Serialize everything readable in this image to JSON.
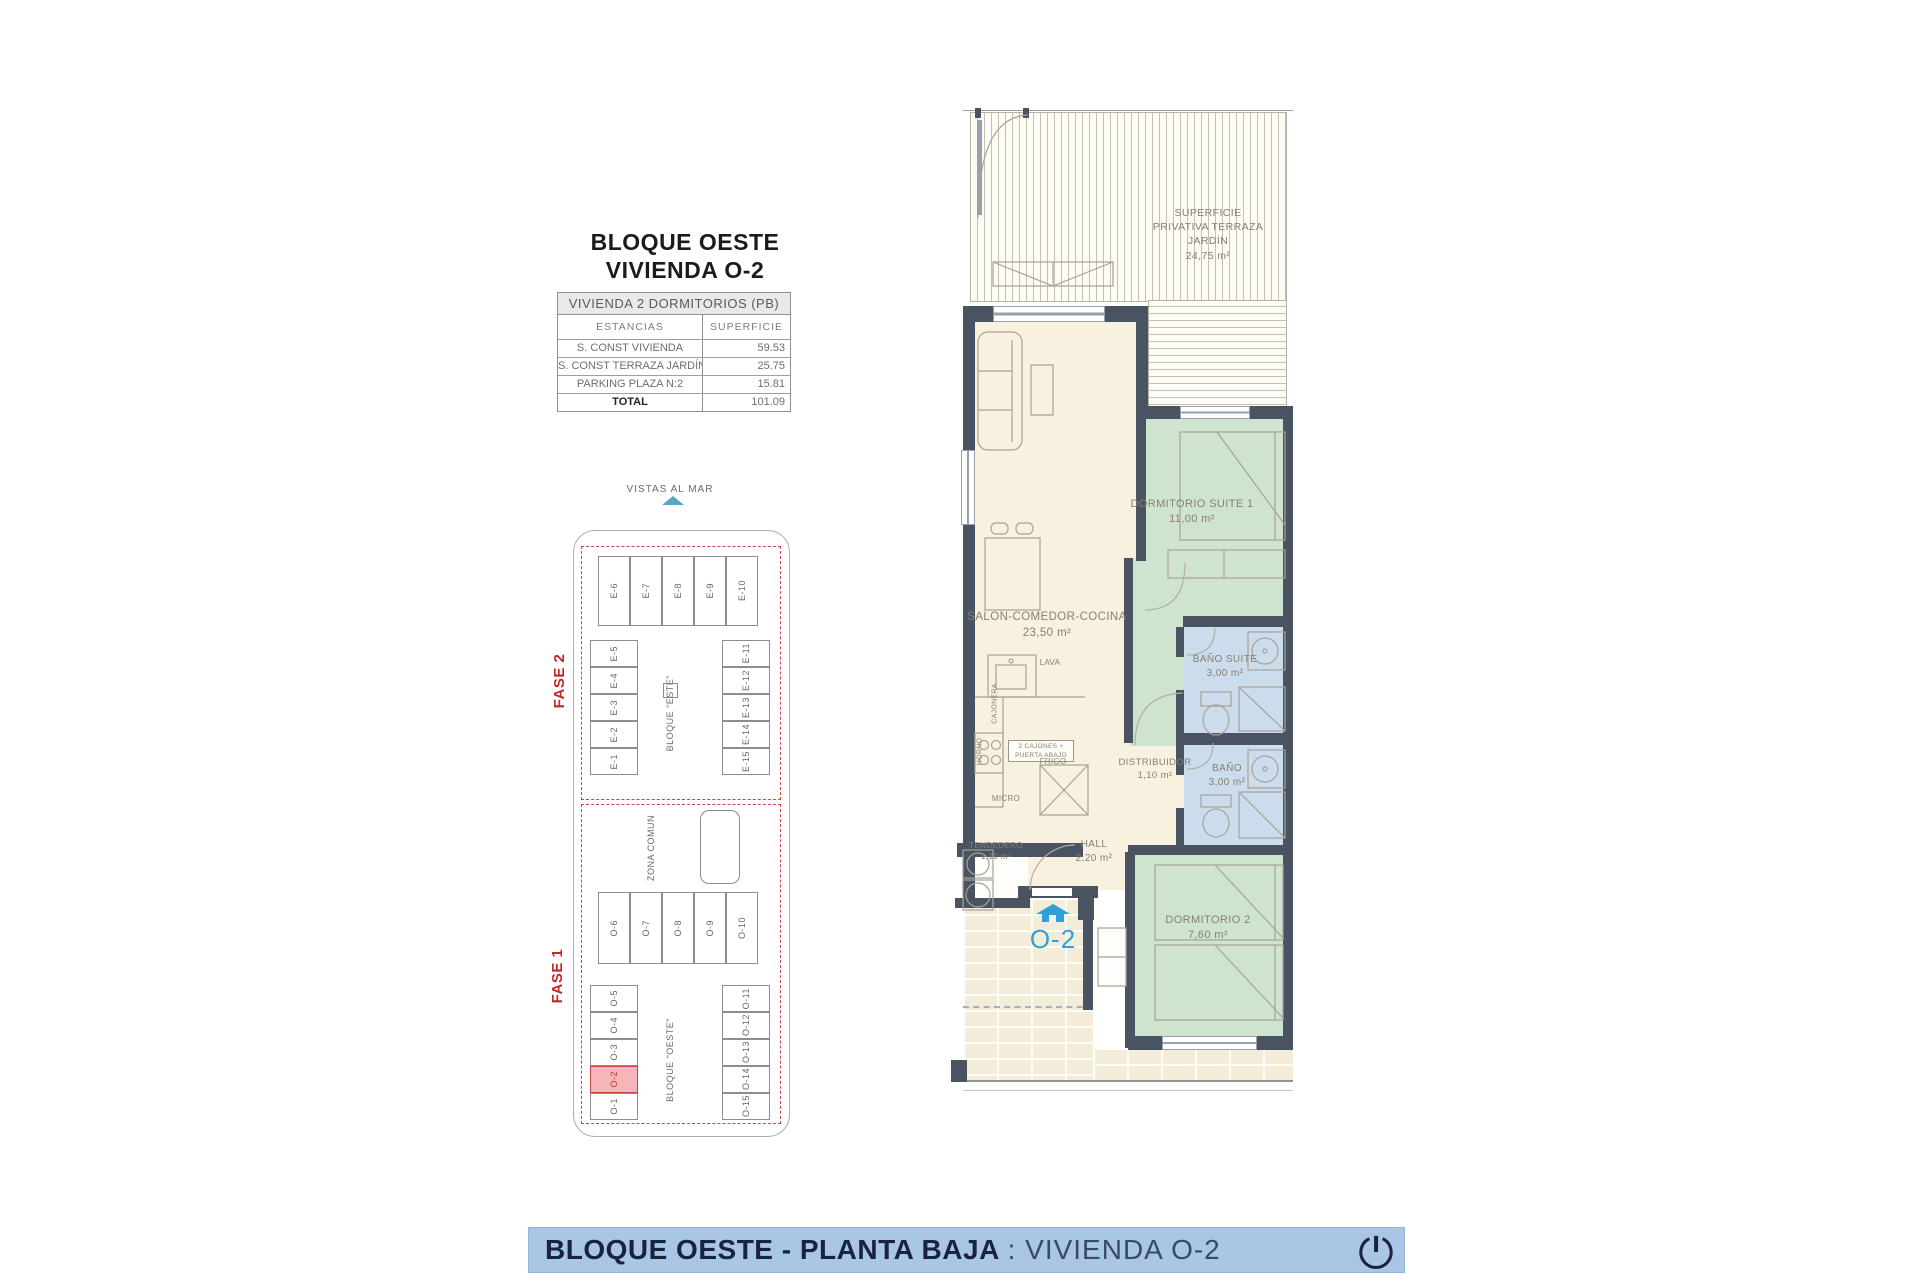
{
  "title": {
    "line1": "BLOQUE OESTE",
    "line2": "VIVIENDA O-2"
  },
  "summary_table": {
    "header": "VIVIENDA 2 DORMITORIOS (PB)",
    "columns": {
      "estancias": "ESTANCIAS",
      "superficie": "SUPERFICIE"
    },
    "rows": [
      {
        "label": "S. CONST VIVIENDA",
        "value": "59.53"
      },
      {
        "label": "S. CONST TERRAZA JARDÍN",
        "value": "25.75"
      },
      {
        "label": "PARKING  PLAZA  N:2",
        "value": "15.81"
      }
    ],
    "total": {
      "label": "TOTAL",
      "value": "101.09"
    }
  },
  "siteplan": {
    "vistas_al_mar": "VISTAS AL MAR",
    "fase2": "FASE 2",
    "fase1": "FASE 1",
    "zona_comun": "ZONA COMUN",
    "bloque_este": "BLOQUE \"ESTE\"",
    "bloque_oeste": "BLOQUE \"OESTE\"",
    "este_top": [
      "E-6",
      "E-7",
      "E-8",
      "E-9",
      "E-10"
    ],
    "este_left": [
      "E-5",
      "E-4",
      "E-3",
      "E-2",
      "E-1"
    ],
    "este_right": [
      "E-11",
      "E-12",
      "E-13",
      "E-14",
      "E-15"
    ],
    "oeste_top": [
      "O-6",
      "O-7",
      "O-8",
      "O-9",
      "O-10"
    ],
    "oeste_left": [
      "O-5",
      "O-4",
      "O-3",
      "O-2",
      "O-1"
    ],
    "oeste_right": [
      "O-11",
      "O-12",
      "O-13",
      "O-14",
      "O-15"
    ],
    "highlighted_unit": "O-2"
  },
  "floorplan": {
    "terrace": {
      "name": "SUPERFICIE\nPRIVATIVA TERRAZA\nJARDÍN",
      "area": "24,75 m²"
    },
    "salon": {
      "name": "SALON-COMEDOR-COCINA",
      "area": "23,50 m²"
    },
    "suite": {
      "name": "DORMITORIO SUITE 1",
      "area": "11,00 m²"
    },
    "bano_suite": {
      "name": "BAÑO SUITE",
      "area": "3,00 m²"
    },
    "bano": {
      "name": "BAÑO",
      "area": "3,00 m²"
    },
    "distribuidor": {
      "name": "DISTRIBUIDOR",
      "area": "1,10 m²"
    },
    "hall": {
      "name": "HALL",
      "area": "2,20 m²"
    },
    "tendedero": {
      "name": "TENDEDERO",
      "area": "1,10 m²"
    },
    "dormitorio2": {
      "name": "DORMITORIO 2",
      "area": "7,60 m²"
    },
    "kitchen": {
      "lava": "LAVA",
      "cajonera": "CAJONERA",
      "cajones": "2 CAJONES +\nPUERTA ABAJO",
      "frigo": "FRIGO",
      "micro": "MICRO",
      "horno": "HORNO"
    },
    "unit_label": "O-2"
  },
  "banner": {
    "title_bold": "BLOQUE OESTE - PLANTA BAJA",
    "title_regular": ": VIVIENDA O-2"
  },
  "colors": {
    "wall": "#4a5362",
    "living_cream": "#f8f1e0",
    "bedroom_green": "#cfe4ce",
    "bath_blue": "#cbdcec",
    "banner_blue": "#a9c7e5",
    "accent_red": "#c13b3b",
    "highlight_pink": "#f5b6ba",
    "unit_blue": "#2f9fd8"
  }
}
